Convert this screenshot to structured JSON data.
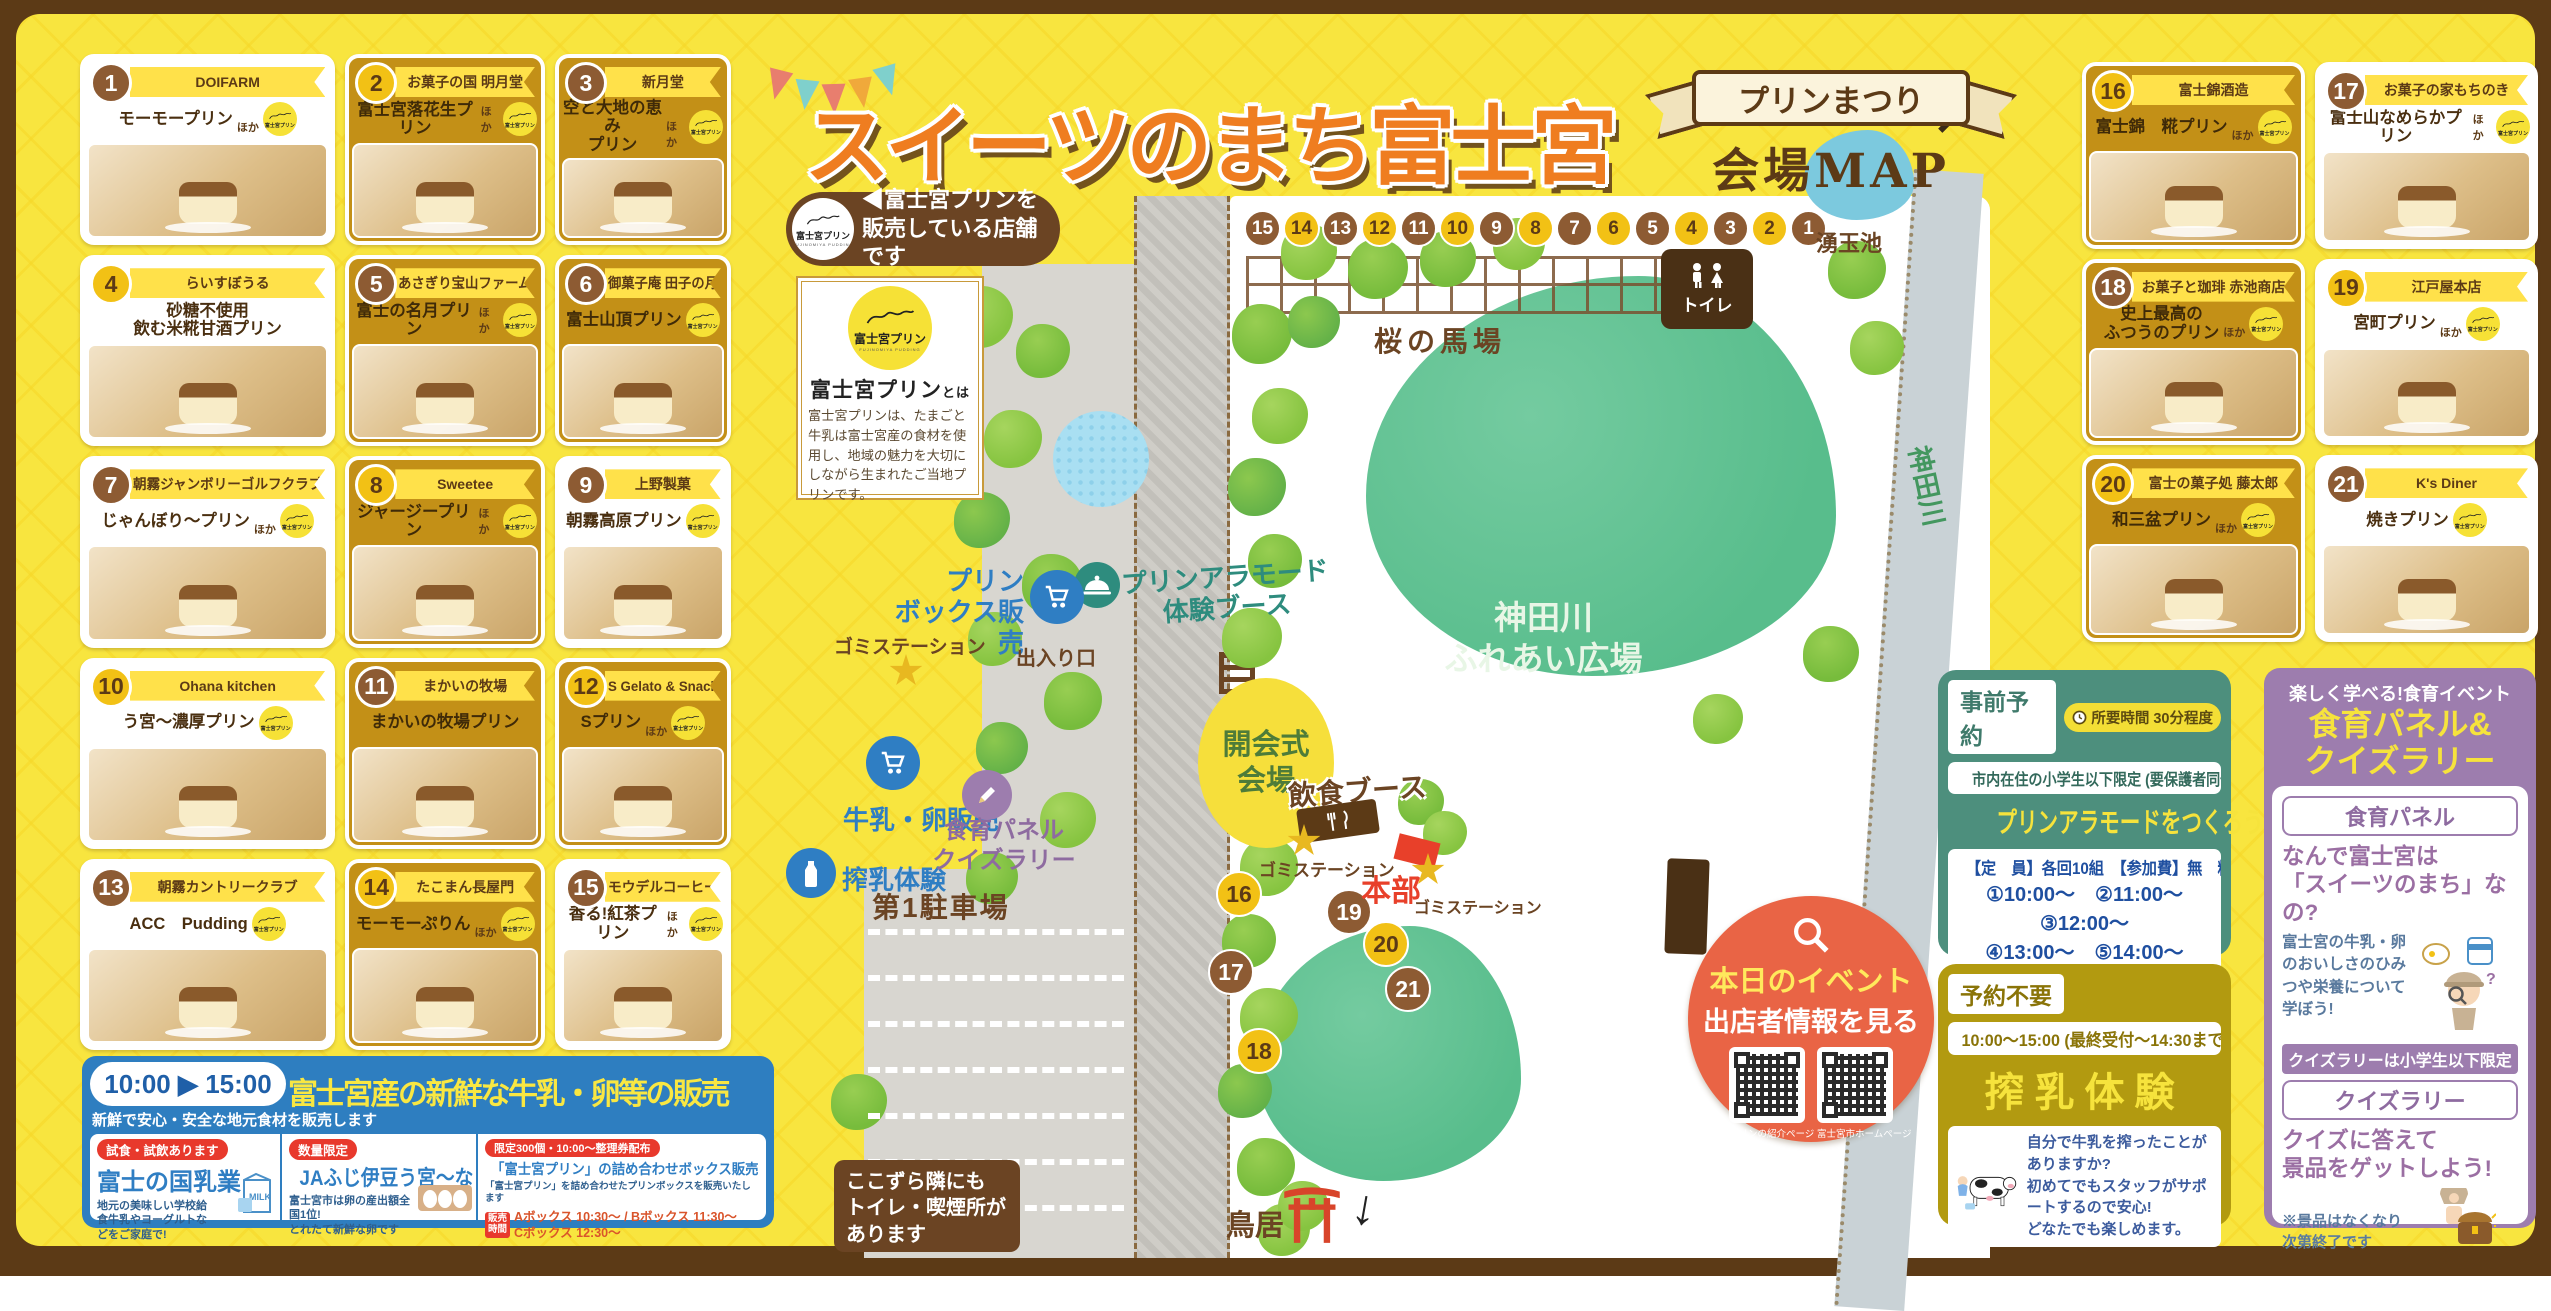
{
  "header": {
    "title": "スイーツのまち富士宮",
    "ribbon_line1": "プリンまつり",
    "ribbon_line2": "会場MAP",
    "seller_note": "◀富士宮プリンを\n販売している店舗です"
  },
  "labels": {
    "hoka": "ほか",
    "badge": "富士宮プリン",
    "badge_sub": "FUJINOMIYA PUDDING"
  },
  "about": {
    "logo_name": "富士宮プリン",
    "logo_sub": "FUJINOMIYA PUDDING",
    "heading": "富士宮プリン",
    "heading_suffix": "とは",
    "body": "富士宮プリンは、たまごと牛乳は富士宮産の食材を使用し、地域の魅力を大切にしながら生まれたご当地プリンです。"
  },
  "left_cards": [
    {
      "num": "1",
      "shop": "DOIFARM",
      "product": "モーモープリン",
      "hoka": true,
      "circle": "brown",
      "style": "white",
      "badge": true
    },
    {
      "num": "2",
      "shop": "お菓子の国 明月堂",
      "product": "富士宮落花生プリン",
      "hoka": true,
      "circle": "yellow",
      "style": "gold",
      "badge": true
    },
    {
      "num": "3",
      "shop": "新月堂",
      "product": "空と大地の恵み\nプリン",
      "hoka": true,
      "circle": "brown",
      "style": "gold",
      "badge": true
    },
    {
      "num": "4",
      "shop": "らいすぼうる",
      "product": "砂糖不使用\n飲む米糀甘酒プリン",
      "hoka": false,
      "circle": "yellow",
      "style": "white",
      "badge": false
    },
    {
      "num": "5",
      "shop": "あさぎり宝山ファーム",
      "product": "富士の名月プリン",
      "hoka": true,
      "circle": "brown",
      "style": "gold",
      "badge": true
    },
    {
      "num": "6",
      "shop": "御菓子庵 田子の月",
      "product": "富士山頂プリン",
      "hoka": false,
      "circle": "brown",
      "style": "gold",
      "badge": true
    },
    {
      "num": "7",
      "shop": "朝霧ジャンボリーゴルフクラブ",
      "product": "じゃんぼり〜プリン",
      "hoka": true,
      "circle": "brown",
      "style": "white",
      "badge": true
    },
    {
      "num": "8",
      "shop": "Sweetee",
      "product": "ジャージープリン",
      "hoka": true,
      "circle": "yellow",
      "style": "gold",
      "badge": true
    },
    {
      "num": "9",
      "shop": "上野製菓",
      "product": "朝霧高原プリン",
      "hoka": false,
      "circle": "brown",
      "style": "white",
      "badge": true
    },
    {
      "num": "10",
      "shop": "Ohana kitchen",
      "product": "う宮〜濃厚プリン",
      "hoka": false,
      "circle": "yellow",
      "style": "white",
      "badge": true
    },
    {
      "num": "11",
      "shop": "まかいの牧場",
      "product": "まかいの牧場プリン",
      "hoka": false,
      "circle": "brown",
      "style": "gold",
      "badge": false
    },
    {
      "num": "12",
      "shop": "S Gelato & Snack",
      "product": "Sプリン",
      "hoka": true,
      "circle": "yellow",
      "style": "gold",
      "badge": true
    },
    {
      "num": "13",
      "shop": "朝霧カントリークラブ",
      "product": "ACC　Pudding",
      "hoka": false,
      "circle": "brown",
      "style": "white",
      "badge": true
    },
    {
      "num": "14",
      "shop": "たこまん長屋門",
      "product": "モーモーぷりん",
      "hoka": true,
      "circle": "yellow",
      "style": "gold",
      "badge": true
    },
    {
      "num": "15",
      "shop": "モウデルコーヒー",
      "product": "香る!紅茶プリン",
      "hoka": true,
      "circle": "brown",
      "style": "white",
      "badge": true
    }
  ],
  "right_cards": [
    {
      "num": "16",
      "shop": "富士錦酒造",
      "product": "富士錦　糀プリン",
      "hoka": true,
      "circle": "yellow",
      "style": "gold",
      "badge": true
    },
    {
      "num": "17",
      "shop": "お菓子の家もちのき",
      "product": "富士山なめらかプリン",
      "hoka": true,
      "circle": "brown",
      "style": "white",
      "badge": true
    },
    {
      "num": "18",
      "shop": "お菓子と珈琲 赤池商店",
      "product": "史上最高の\nふつうのプリン",
      "hoka": true,
      "circle": "brown",
      "style": "gold",
      "badge": true
    },
    {
      "num": "19",
      "shop": "江戸屋本店",
      "product": "宮町プリン",
      "hoka": true,
      "circle": "yellow",
      "style": "white",
      "badge": true
    },
    {
      "num": "20",
      "shop": "富士の菓子処 藤太郎",
      "product": "和三盆プリン",
      "hoka": true,
      "circle": "yellow",
      "style": "gold",
      "badge": true
    },
    {
      "num": "21",
      "shop": "K's Diner",
      "product": "焼きプリン",
      "hoka": false,
      "circle": "brown",
      "style": "white",
      "badge": true
    }
  ],
  "map": {
    "numbers_row": [
      "15",
      "14",
      "13",
      "12",
      "11",
      "10",
      "9",
      "8",
      "7",
      "6",
      "5",
      "4",
      "3",
      "2",
      "1"
    ],
    "scatter": [
      "16",
      "17",
      "18",
      "19",
      "20",
      "21"
    ],
    "pond_label": "湧玉池",
    "baba_label": "桜の馬場",
    "toilet_label": "トイレ",
    "alamode_label": "プリンアラモード\n体験ブース",
    "plaza_label": "神田川\nふれあい広場",
    "river_label": "神田川",
    "box_sale_label": "プリン\nボックス販売",
    "gomi_label": "ゴミステーション",
    "exit_label": "出入り口",
    "milk_sale_label": "牛乳・卵販売",
    "milking_label": "搾乳体験",
    "shokuiku_label": "食育パネル\nクイズラリー",
    "opening_label": "開会式\n会場",
    "food_label": "飲食ブース",
    "honbu_label": "本部",
    "parking_label": "第1駐車場",
    "torii_label": "鳥居",
    "side_note": "ここずら隣にも\nトイレ・喫煙所が\nあります",
    "arrow_up_glyph": "↗",
    "arrow_down_glyph": "↓"
  },
  "qr_circle": {
    "line1": "本日のイベント",
    "line2": "出店者情報を見る",
    "qr1_caption": "プリンの紹介ページ",
    "qr2_caption": "富士宮市ホームページ"
  },
  "panels": {
    "reserve": {
      "tag": "事前予約",
      "duration": "所要時間 30分程度",
      "restriction": "市内在住の小学生以下限定 (要保護者同伴)",
      "title": "プリンアラモードをつくろう",
      "capacity": "【定　員】各回10組　【参加費】無　料",
      "slots": "①10:00〜　②11:00〜　③12:00〜\n④13:00〜　⑤14:00〜",
      "note": "事前申込者のみ\n対象となります"
    },
    "milking": {
      "tag": "予約不要",
      "time": "10:00〜15:00 (最終受付〜14:30まで)",
      "title": "搾乳体験",
      "desc": "自分で牛乳を搾ったことがありますか?\n初めてでもスタッフがサポートするので安心!\nどなたでも楽しめます。"
    },
    "quiz": {
      "subtitle": "楽しく学べる!食育イベント",
      "title": "食育パネル&\nクイズラリー",
      "sec1_tag": "食育パネル",
      "sec1_title": "なんで富士宮は\n「スイーツのまち」なの?",
      "sec1_desc": "富士宮の牛乳・卵のおいしさのひみつや栄養について学ぼう!",
      "limit": "クイズラリーは小学生以下限定",
      "sec2_tag": "クイズラリー",
      "sec2_title": "クイズに答えて\n景品をゲットしよう!",
      "note": "※景品はなくなり\n次第終了です"
    }
  },
  "milk_banner": {
    "time": "10:00 ▶ 15:00",
    "time_note": "新鮮で安心・安全な地元食材を販売します",
    "title": "富士宮産の新鮮な牛乳・卵等の販売",
    "sections": [
      {
        "badge": "試食・試飲あります",
        "name": "富士の国乳業",
        "desc": "地元の美味しい学校給食牛乳やヨーグルトなどをご家庭で!"
      },
      {
        "badge": "数量限定",
        "name": "JAふじ伊豆う宮〜な",
        "desc": "富士宮市は卵の産出額全国1位!\nとれたて新鮮な卵です"
      },
      {
        "badge": "限定300個・10:00〜整理券配布",
        "name": "「富士宮プリン」の詰め合わせボックス販売",
        "desc": "「富士宮プリン」を詰め合わせたプリンボックスを販売いたします",
        "sale_tag": "販売\n時間",
        "times": "Aボックス 10:30〜 / Bボックス 11:30〜\nCボックス 12:30〜"
      }
    ]
  }
}
